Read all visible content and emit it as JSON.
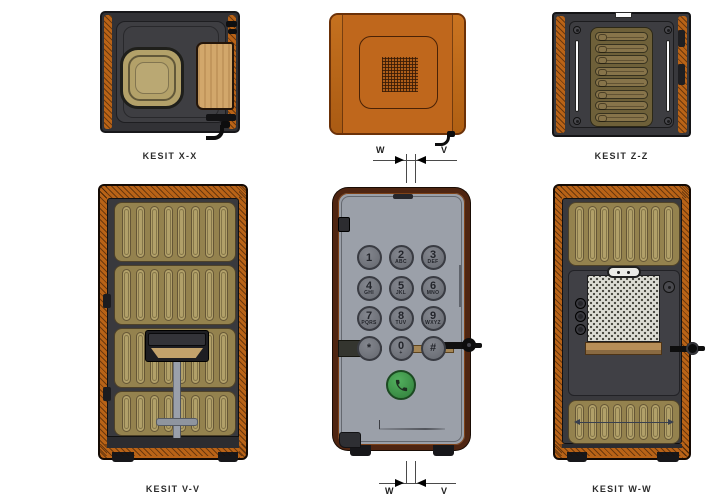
{
  "drawing": {
    "title": "phone-booth-cad-section-views",
    "views": {
      "top_left": {
        "label": "KESIT X-X"
      },
      "top_middle": {
        "section_marker": {
          "left": "W",
          "right": "V"
        }
      },
      "top_right": {
        "label": "KESIT Z-Z",
        "slat_count": 8
      },
      "bottom_left": {
        "label": "KESIT V-V",
        "panel_count": 4,
        "slats_per_panel": 8
      },
      "bottom_middle": {
        "section_marker": {
          "left": "W",
          "right": "V"
        },
        "keypad": {
          "buttons": [
            {
              "digit": "1",
              "letters": ""
            },
            {
              "digit": "2",
              "letters": "ABC"
            },
            {
              "digit": "3",
              "letters": "DEF"
            },
            {
              "digit": "4",
              "letters": "GHI"
            },
            {
              "digit": "5",
              "letters": "JKL"
            },
            {
              "digit": "6",
              "letters": "MNO"
            },
            {
              "digit": "7",
              "letters": "PQRS"
            },
            {
              "digit": "8",
              "letters": "TUV"
            },
            {
              "digit": "9",
              "letters": "WXYZ"
            },
            {
              "digit": "*",
              "letters": ""
            },
            {
              "digit": "0",
              "letters": "+"
            },
            {
              "digit": "#",
              "letters": ""
            }
          ],
          "call_button_icon": "phone-handset-icon"
        }
      },
      "bottom_right": {
        "label": "KESIT W-W",
        "top_slats": 8,
        "bottom_slats": 8
      }
    },
    "colors": {
      "shell_orange": "#b96317",
      "roof_orange": "#bf671c",
      "frame_dark": "#39393d",
      "slat_tan": "#b1a069",
      "olive_panel": "#6e6039",
      "door_gray": "#9ba0a9",
      "mahogany": "#4f2511",
      "button_gray": "#74777f",
      "call_green": "#3f9b4b",
      "wood_table": "#d2a76b",
      "perforated_panel": "#dcdcd4"
    }
  }
}
